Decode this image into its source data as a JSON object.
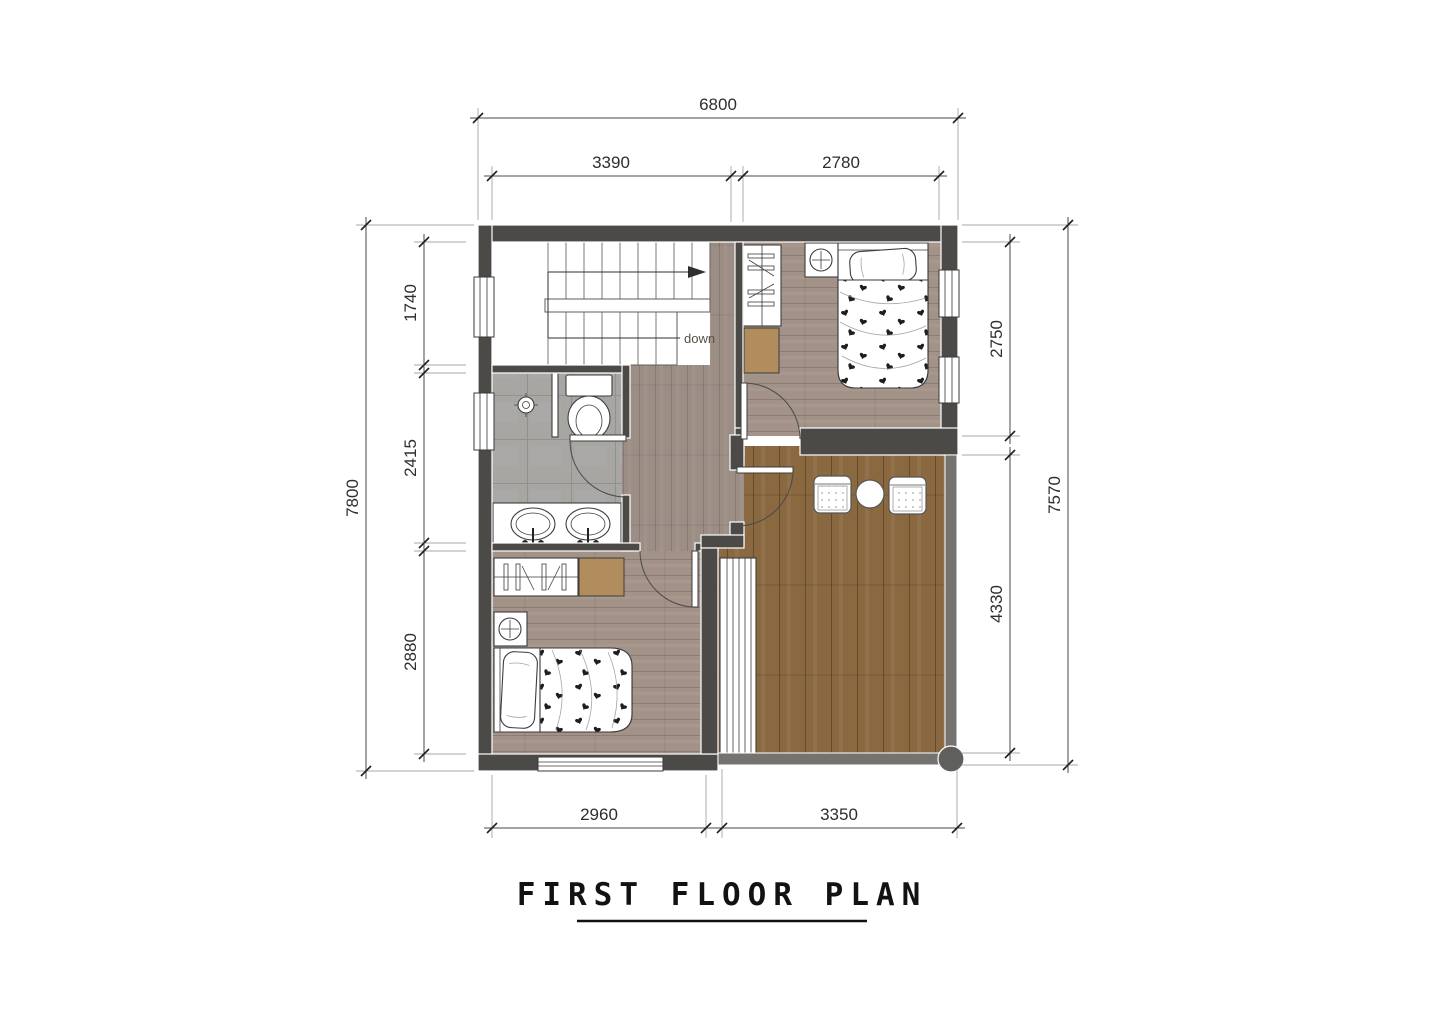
{
  "title": "FIRST FLOOR PLAN",
  "labels": {
    "stair_direction": "down"
  },
  "dimensions": {
    "top_overall": "6800",
    "top_segments": [
      "3390",
      "2780"
    ],
    "left_overall": "7800",
    "left_segments": [
      "1740",
      "2415",
      "2880"
    ],
    "right_segments": [
      "2750",
      "4330"
    ],
    "right_overall": "7570",
    "bottom_segments": [
      "2960",
      "3350"
    ]
  },
  "colors": {
    "wall-dark": "#4b4a47",
    "wall-light": "#747370",
    "floor-bedroom": "#a29288",
    "floor-hall": "#9c8e85",
    "floor-balcony": "#8a6840",
    "floor-bath": "#a8a6a3",
    "cabinet": "#b18d5d",
    "dim-text": "#2e2e2e",
    "title-color": "#121212",
    "down-label": "#57504a"
  }
}
